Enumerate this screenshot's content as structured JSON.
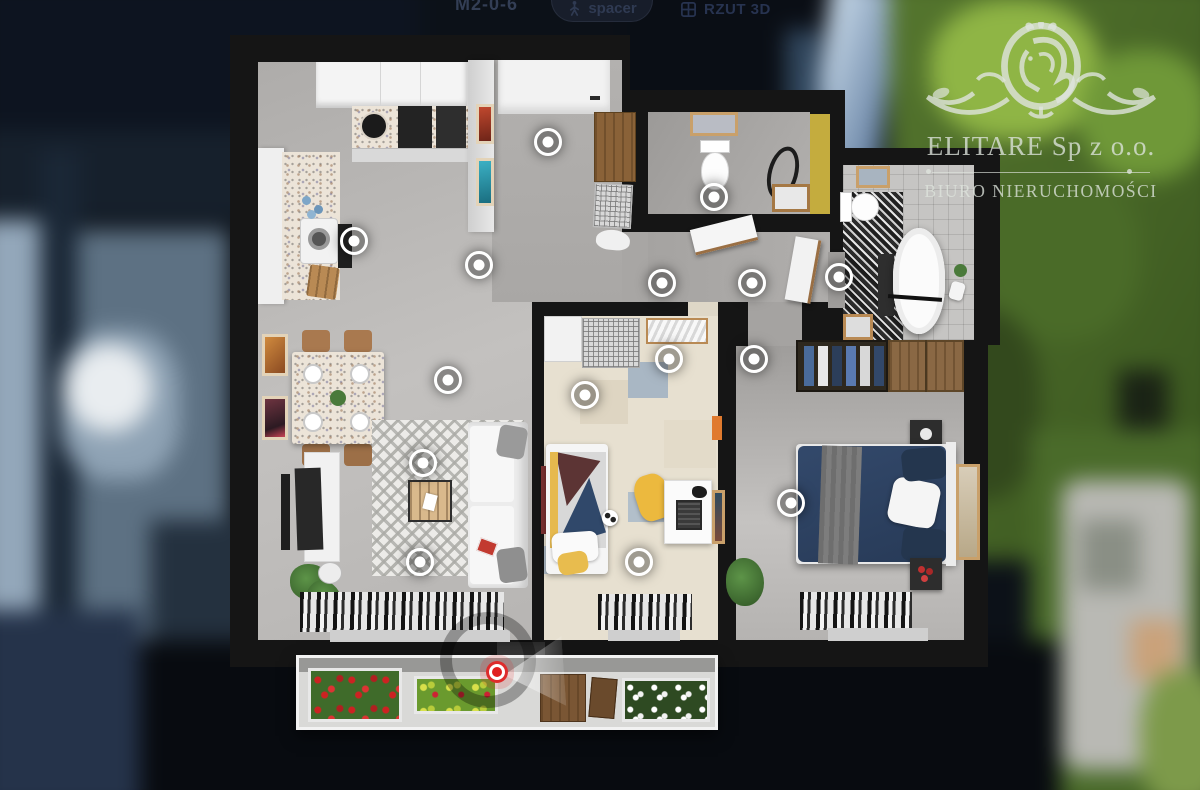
{
  "toolbar": {
    "unit_label": "M2-0-6",
    "walk_label": "spacer",
    "view_label": "RZUT 3D"
  },
  "watermark": {
    "company": "ELITARE Sp z o.o.",
    "subtitle": "BIURO NIERUCHOMOŚCI"
  },
  "floorplan": {
    "hotspots": [
      {
        "id": "entry",
        "x": 551,
        "y": 145
      },
      {
        "id": "kitchen",
        "x": 357,
        "y": 244
      },
      {
        "id": "hall",
        "x": 482,
        "y": 268
      },
      {
        "id": "wc",
        "x": 717,
        "y": 200
      },
      {
        "id": "corridor-left",
        "x": 665,
        "y": 286
      },
      {
        "id": "corridor-right",
        "x": 755,
        "y": 286
      },
      {
        "id": "bathroom-door",
        "x": 842,
        "y": 280
      },
      {
        "id": "living-north",
        "x": 451,
        "y": 383
      },
      {
        "id": "living-rug",
        "x": 426,
        "y": 466
      },
      {
        "id": "living-south",
        "x": 423,
        "y": 565
      },
      {
        "id": "kids-room-door",
        "x": 672,
        "y": 362
      },
      {
        "id": "kids-room",
        "x": 588,
        "y": 398
      },
      {
        "id": "kids-room-window",
        "x": 642,
        "y": 565
      },
      {
        "id": "bedroom-door",
        "x": 757,
        "y": 362
      },
      {
        "id": "bedroom",
        "x": 794,
        "y": 506
      }
    ],
    "current_position": {
      "id": "balcony",
      "x": 497,
      "y": 672
    }
  },
  "colors": {
    "hotspot": "#ffffff",
    "position_marker": "#e01e1e",
    "watermark_text": "#dee4dd"
  }
}
